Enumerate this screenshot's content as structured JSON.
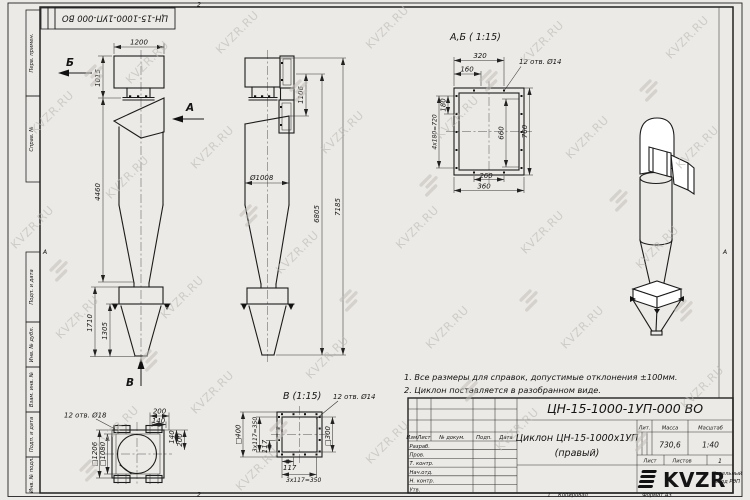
{
  "page": {
    "stamp_top": "ЦН-15-1000-1УП-000 ВО",
    "zone_top": "2",
    "zone_bottom": "2",
    "zone_right": "А",
    "zone_left": "А",
    "copy_num": "1",
    "copied": "Копировал",
    "format": "Формат А3"
  },
  "watermark": {
    "text": "KVZR.RU"
  },
  "left_strip": {
    "b1": "Перв. примен.",
    "b2": "Справ. №",
    "b3": "Подп. и дата",
    "b4": "Инв. № дубл.",
    "b5": "Взам. инв. №",
    "b6": "Подп. и дата",
    "b7": "Инв. № подл."
  },
  "front": {
    "dim_width": "1200",
    "dim_inlet": "1015",
    "dim_body": "4460",
    "dim_bottom": "1710",
    "dim_cone": "1305",
    "arrow_a": "А",
    "arrow_b": "Б",
    "arrow_v": "В"
  },
  "side": {
    "dim_duct": "1106",
    "dim_dia": "Ø1008",
    "dim_h1": "6805",
    "dim_h2": "7185"
  },
  "section_ab": {
    "title": "А,Б ( 1:15)",
    "holes": "12 отв. Ø14",
    "dim_320": "320",
    "dim_160": "160",
    "dim_180": "180",
    "dim_pitch": "4х180=720",
    "dim_660": "660",
    "dim_760": "760",
    "dim_260": "260",
    "dim_360": "360"
  },
  "view_v": {
    "title": "В (1:15)",
    "left": {
      "holes": "12 отв. Ø18",
      "dim_200t": "200",
      "dim_140t": "140",
      "dim_140r": "140",
      "dim_200r": "200",
      "sq_outer": "□1206",
      "sq_inner": "□1080"
    },
    "right": {
      "holes": "12 отв. Ø14",
      "sq_outer": "□400",
      "pitch_l": "3х117=350",
      "dim_117l": "117",
      "dim_117b": "117",
      "pitch_b": "3х117=350",
      "sq_inner": "□300"
    }
  },
  "notes": {
    "n1": "1. Все размеры для справок, допустимые отклонения ±100мм.",
    "n2": "2. Циклон поставляется в разобранном виде."
  },
  "title_block": {
    "designation": "ЦН-15-1000-1УП-000 ВО",
    "name1": "Циклон ЦН-15-1000х1УП",
    "name2": "(правый)",
    "col_izm": "Изм.",
    "col_list": "Лист",
    "col_doc": "№ докум.",
    "col_podp": "Подп.",
    "col_data": "Дата",
    "row1": "Разраб.",
    "row2": "Пров.",
    "row3": "Т. контр.",
    "row4": "Нач.отд.",
    "row5": "Н. контр.",
    "row6": "Утв.",
    "lit": "Лит.",
    "mass_label": "Масса",
    "scale_label": "Масштаб",
    "mass": "730,6",
    "scale": "1:40",
    "sheet": "Лист",
    "sheets": "Листов",
    "sheets_val": "1",
    "logo": "KVZR",
    "company1": "Котельный",
    "company2": "завод РЭП"
  }
}
